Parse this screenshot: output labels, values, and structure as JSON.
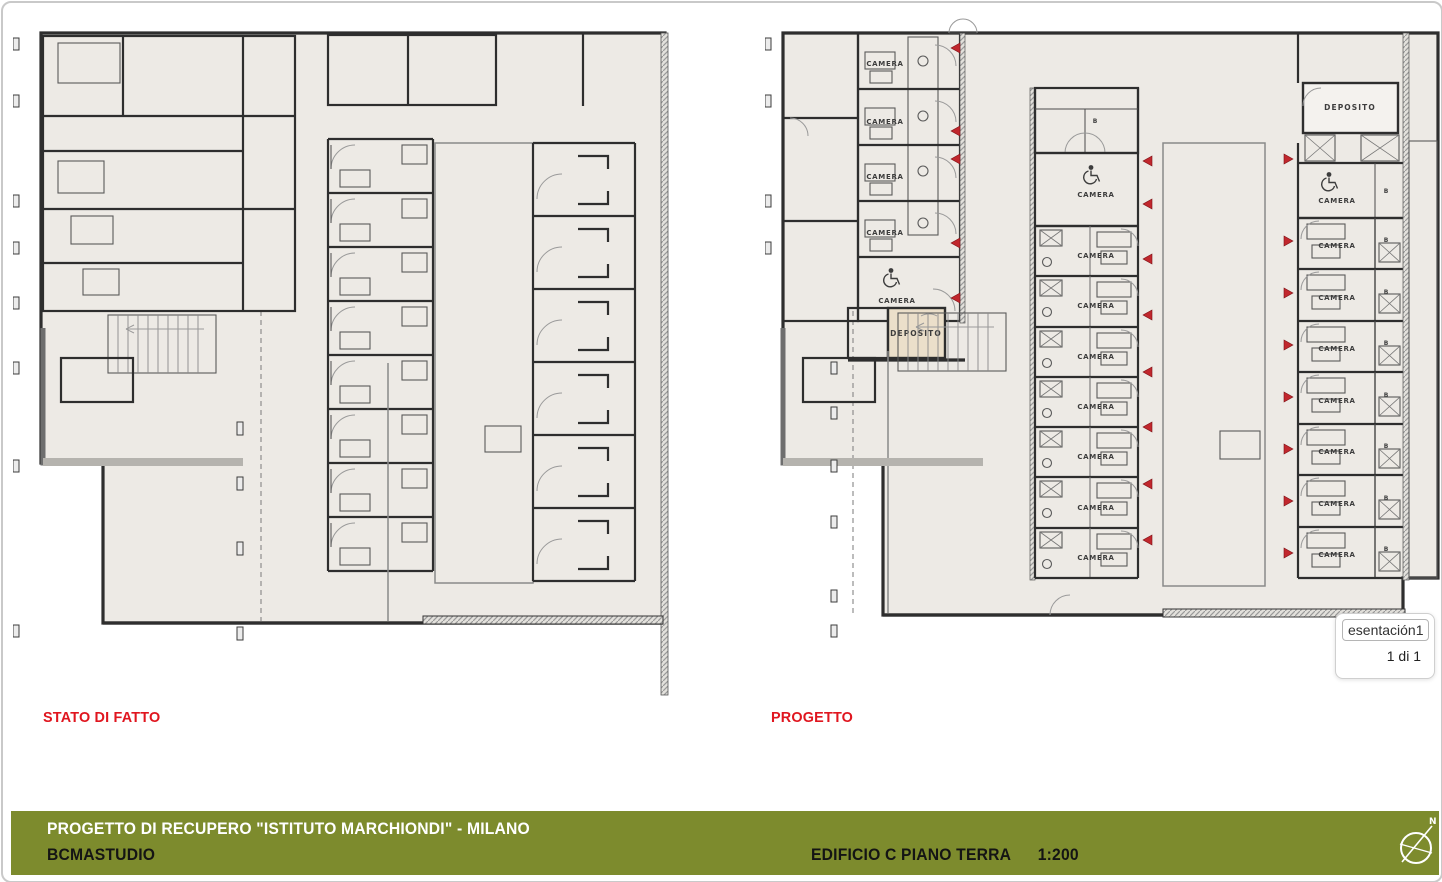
{
  "plans": {
    "stato": {
      "caption": "STATO DI FATTO"
    },
    "progetto": {
      "caption": "PROGETTO"
    }
  },
  "room_labels": {
    "camera": "CAMERA",
    "deposito": "DEPOSITO",
    "bath": "B"
  },
  "popup": {
    "slide_name": "esentación1",
    "page_indicator": "1 di 1"
  },
  "footer": {
    "project_title": "PROGETTO DI RECUPERO \"ISTITUTO MARCHIONDI\" - MILANO",
    "studio": "BCMASTUDIO",
    "sheet_title": "EDIFICIO C PIANO TERRA",
    "scale": "1:200",
    "north_label": "N"
  },
  "colors": {
    "accent_red": "#e0161f",
    "marker_red": "#c1272d",
    "footer_olive": "#7d8b2d",
    "plan_fill": "#edeae5",
    "deposito_fill": "#ebdfca",
    "window_border": "#c9c9c9"
  }
}
